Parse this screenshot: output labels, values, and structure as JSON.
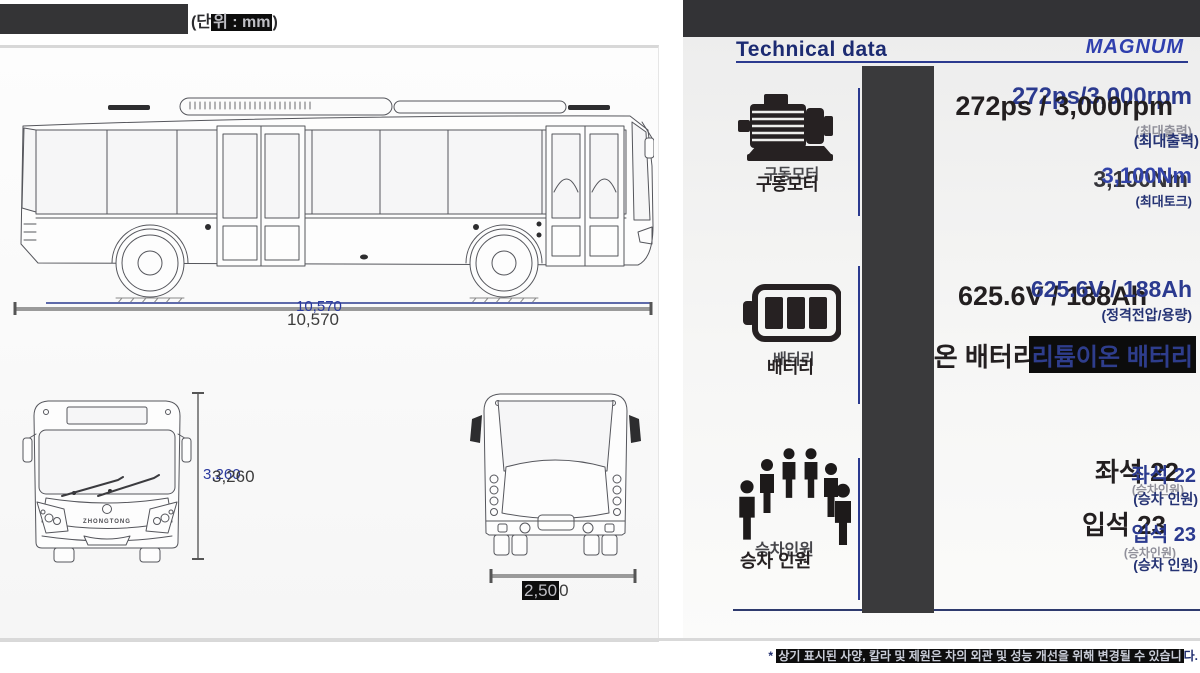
{
  "unit": {
    "prefix": "(단",
    "highlight": "위 : mm",
    "suffix": ")"
  },
  "drawings": {
    "length_label": "10,570",
    "height_label": "3,260",
    "width_hl": "2,50",
    "width_tail": "0",
    "front_badge": "ZHONGTONG"
  },
  "header": {
    "title": "Technical data",
    "brand": "MAGNUM"
  },
  "icons": {
    "motor": "motor-icon",
    "battery": "battery-icon",
    "passengers": "passengers-icon"
  },
  "motor": {
    "label": "구동모터",
    "value_main": "272ps / 3,000rpm",
    "value_ghost": "272ps/3,000rpm",
    "caption": "(최대출력)",
    "torque_value": "3,100Nm",
    "torque_caption": "(최대토크)"
  },
  "battery": {
    "label": "배터리",
    "value": "625.6V / 188Ah",
    "caption": "(정격전압/용량)",
    "type_value": "리튬이온 배터리"
  },
  "passengers": {
    "label_main": "승차 인원",
    "label_ghost": "승차인원",
    "seat_value": "좌석 22",
    "seat_caption_main": "(승차 인원)",
    "seat_caption_ghost": "(승차인원)",
    "stand_value": "입석 23",
    "stand_caption_main": "(승차 인원)",
    "stand_caption_ghost": "(승차인원)"
  },
  "footnote": {
    "prefix": "* ",
    "highlight": "상기 표시된 사양, 칼라 및 제원은 차의 외관 및 성능 개선을 위해 변경될 수 있습니",
    "tail": "다."
  },
  "colors": {
    "dark_text": "#231f20",
    "navy_text": "#2b3a8f",
    "brand_blue": "#2f3fae",
    "bar_gray": "#3a3a3c",
    "rule_gray": "#d9d9d9"
  }
}
